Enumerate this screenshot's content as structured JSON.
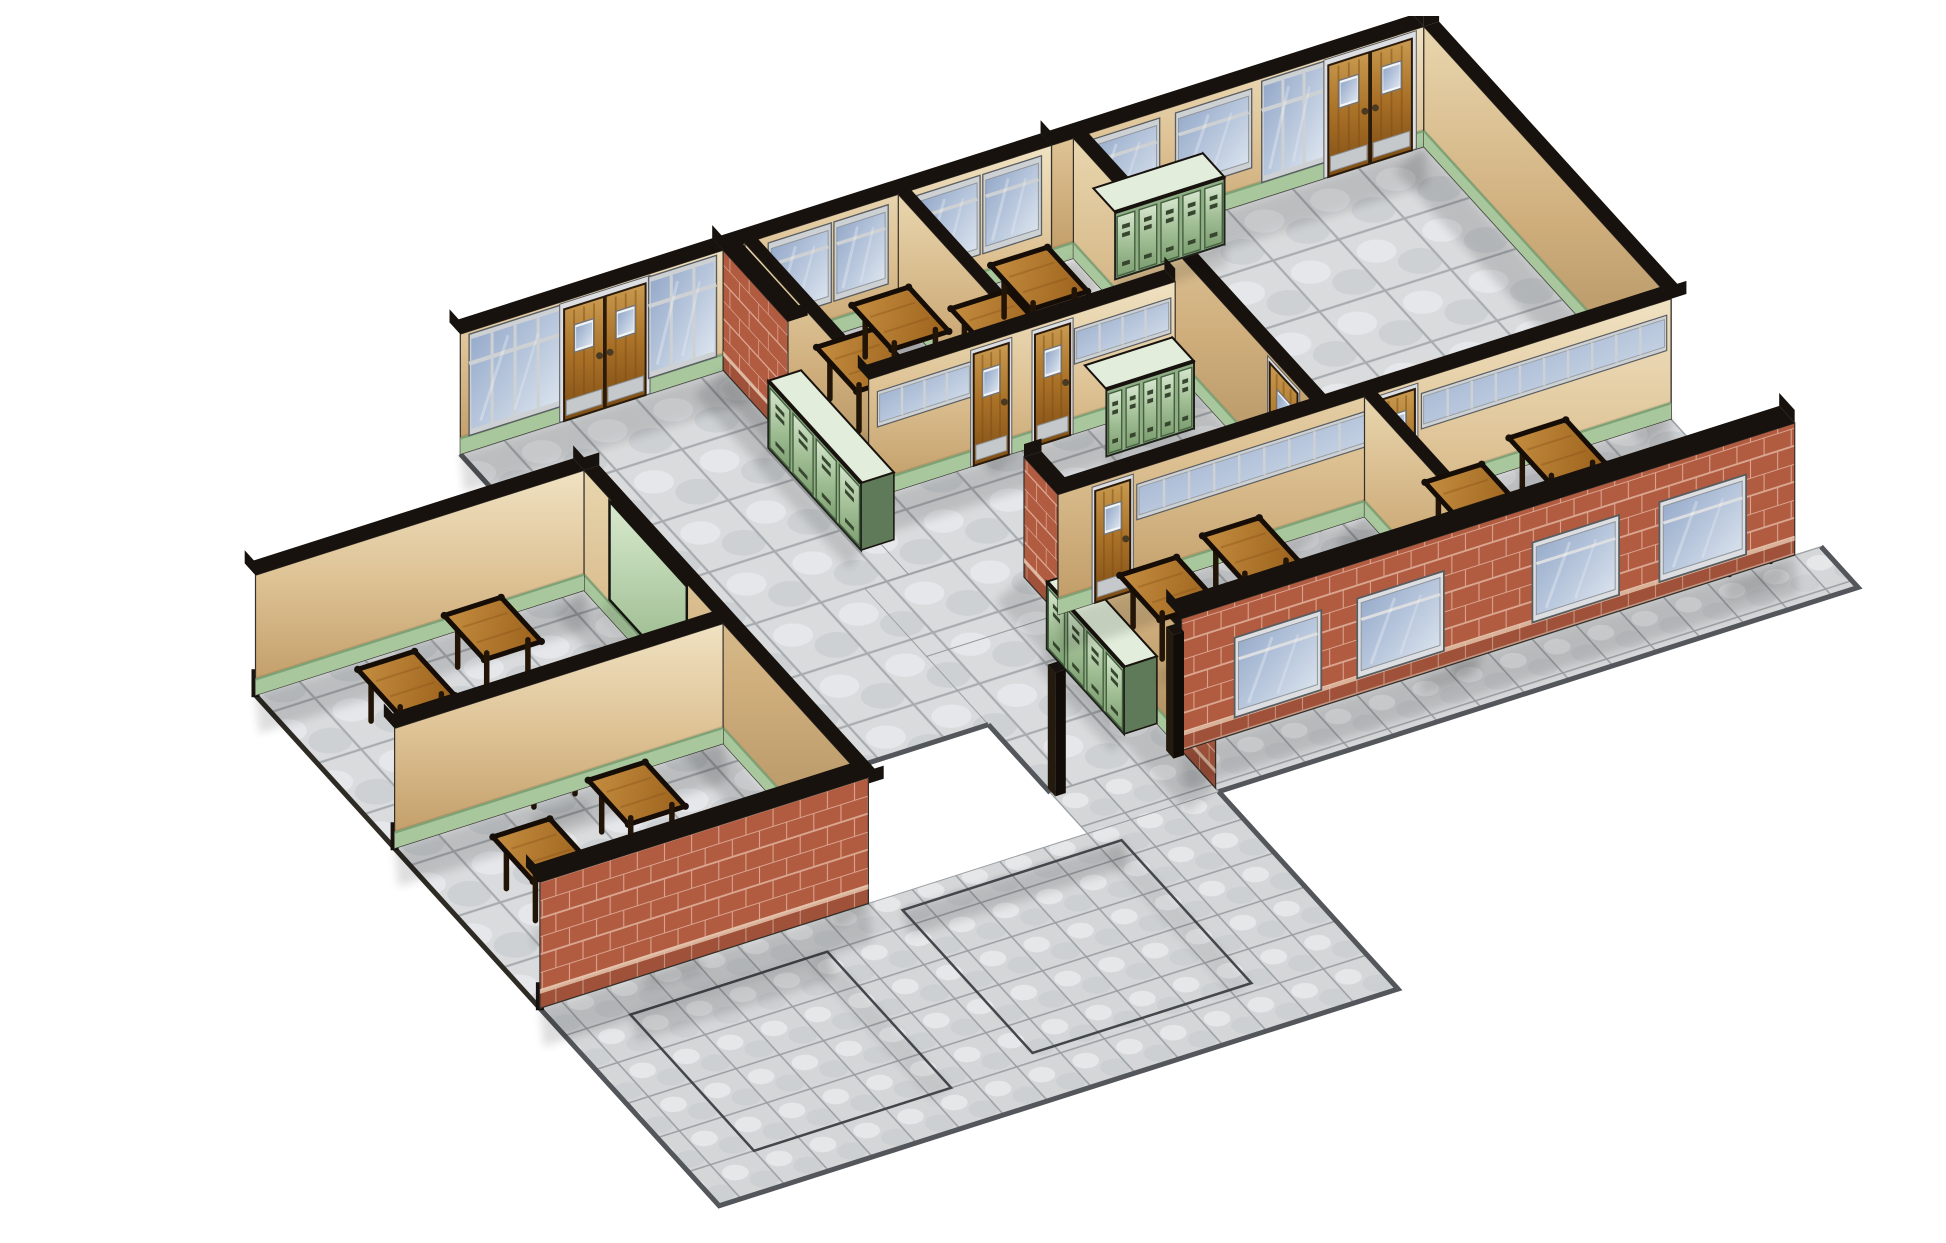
{
  "meta": {
    "description": "Isometric cutaway 3D rendering of a single-storey school wing with classrooms, corridors, locker banks, an entrance hall and an outdoor paved plaza",
    "view": "axonometric cutaway from south-west, roof removed, walls cut with black caps"
  },
  "inventory": {
    "rooms": [
      {
        "name": "entrance-hall",
        "features": [
          "glazed north wall",
          "double wooden doors",
          "green display board"
        ]
      },
      {
        "name": "left-classroom-1",
        "tables": 3
      },
      {
        "name": "left-classroom-2",
        "tables": 4
      },
      {
        "name": "north-classroom-1",
        "tables": 2,
        "windows": 2
      },
      {
        "name": "north-classroom-2",
        "tables": 2,
        "windows": 2
      },
      {
        "name": "northeast-room",
        "tables": 0,
        "locker_doors": 5,
        "features": [
          "windows",
          "glazed end with double doors"
        ]
      },
      {
        "name": "south-classroom-1",
        "tables": 5
      },
      {
        "name": "south-classroom-2",
        "tables": 5
      }
    ],
    "tables_total": 21,
    "locker_banks": [
      {
        "location": "entrance-hall",
        "doors": 4
      },
      {
        "location": "corridor",
        "doors": 5
      },
      {
        "location": "northeast-room",
        "doors": 5
      },
      {
        "location": "south-corridor",
        "doors": 4
      }
    ],
    "doors": {
      "single_wood": 5,
      "double_wood": 2
    },
    "windows": {
      "large": 6,
      "brick_wall": 4,
      "clerestory_bands": 4,
      "glazed_sections": 4
    },
    "plaza": {
      "sunken_pads": 2
    },
    "brick_piers": 3,
    "doorway_posts": 2
  },
  "palette": {
    "wall_face": [
      "#f0e2c2",
      "#ddc193",
      "#bf9a64"
    ],
    "wall_side": [
      "#e9d6ae",
      "#cfae7c",
      "#a8875a"
    ],
    "glass": [
      "#8ea4c6",
      "#b7c6dc",
      "#e3eaf2"
    ],
    "door_wood": [
      "#c99b50",
      "#a86f26",
      "#7d4d15"
    ],
    "table_wood": [
      "#c68f41",
      "#9f651f"
    ],
    "locker_door": [
      "#d7e7cf",
      "#a3c097",
      "#7c9e70"
    ],
    "board_green": [
      "#d8eacd",
      "#8fb283"
    ],
    "wainscot": "#a8c79d",
    "wainscot_dark": "#7da276",
    "frame": "#ced1d4",
    "frame_dark": "#5a5e62",
    "cap": "#17120e",
    "brick": "#b15b41",
    "mortar": "#daa58f",
    "tile": "#d9dbdd",
    "tile_plaza": "#d4d6d8",
    "grout": "#a8acaf",
    "grout_plaza": "#999ea1",
    "tile_light": "#e7e9eb",
    "tile_dark": "#cbcfd2",
    "locker_body": "#8fae85",
    "locker_side": "#5f7a58",
    "locker_top": "#e2eedb",
    "locker_frame": "#45603f",
    "locker_vent": "#37462f",
    "table_leg": "#221507"
  },
  "scene": {
    "proj": {
      "ux": 0.952,
      "uy": -0.304,
      "vx": 0.672,
      "vy": 0.74,
      "s": 46,
      "H": 120,
      "ox": 70,
      "oy": 550
    },
    "objects": [
      {
        "t": "floor",
        "name": "entrance-hall-floor",
        "r": [
          8,
          0,
          6,
          10
        ],
        "p": "i"
      },
      {
        "t": "floor",
        "name": "corridor-east-floor",
        "r": [
          14,
          4,
          8,
          2
        ],
        "p": "i"
      },
      {
        "t": "floor",
        "name": "corridor-mid-floor",
        "r": [
          13,
          6,
          9,
          2
        ],
        "p": "i"
      },
      {
        "t": "floor",
        "name": "corridor-south-floor",
        "r": [
          13,
          8,
          3,
          4
        ],
        "p": "i"
      },
      {
        "t": "floor",
        "name": "north-classroom-1-floor",
        "r": [
          14.5,
          0,
          3.5,
          4
        ],
        "p": "i"
      },
      {
        "t": "floor",
        "name": "north-classroom-2-floor",
        "r": [
          18,
          0,
          3.5,
          4
        ],
        "p": "i"
      },
      {
        "t": "floor",
        "name": "northeast-room-floor",
        "r": [
          22,
          0,
          8,
          8
        ],
        "p": "i"
      },
      {
        "t": "floor",
        "name": "south-classroom-1-floor",
        "r": [
          16,
          8,
          7,
          4
        ],
        "p": "i"
      },
      {
        "t": "floor",
        "name": "south-classroom-2-floor",
        "r": [
          23,
          8,
          7,
          4
        ],
        "p": "i"
      },
      {
        "t": "floor",
        "name": "left-classroom-1-floor",
        "r": [
          0.5,
          4,
          7.5,
          4.5
        ],
        "p": "i"
      },
      {
        "t": "floor",
        "name": "left-classroom-2-floor",
        "r": [
          0.5,
          8.5,
          7.5,
          4.7
        ],
        "p": "i"
      },
      {
        "t": "floor",
        "name": "plaza-paving",
        "r": [
          0.5,
          13.2,
          15.5,
          5.8
        ],
        "p": "p"
      },
      {
        "t": "floor",
        "name": "south-walkway-paving",
        "r": [
          13,
          12,
          17.6,
          1.2
        ],
        "p": "p"
      },
      {
        "t": "inset",
        "name": "plaza-sunken-pad-1",
        "r": [
          2,
          14,
          4.5,
          4
        ]
      },
      {
        "t": "inset",
        "name": "plaza-sunken-pad-2",
        "r": [
          8.5,
          13.6,
          5,
          4.2
        ]
      },
      {
        "t": "trim",
        "name": "floor-edge-hall-west",
        "pts": [
          [
            8,
            0
          ],
          [
            8,
            4
          ]
        ]
      },
      {
        "t": "trim",
        "name": "floor-edge-hall-south",
        "pts": [
          [
            8,
            10
          ],
          [
            13,
            10
          ]
        ]
      },
      {
        "t": "trim",
        "name": "floor-edge-corridor-west",
        "pts": [
          [
            13,
            10
          ],
          [
            13,
            12
          ]
        ]
      },
      {
        "t": "trim",
        "name": "floor-edge-plaza",
        "pts": [
          [
            0.5,
            13.2
          ],
          [
            0.5,
            19
          ],
          [
            16,
            19
          ],
          [
            16,
            13.2
          ]
        ]
      },
      {
        "t": "trim",
        "name": "floor-edge-walkway",
        "pts": [
          [
            16,
            13.2
          ],
          [
            30.6,
            13.2
          ],
          [
            30.6,
            12
          ]
        ]
      },
      {
        "t": "stub",
        "name": "cut-wall-edge-west",
        "x": 0.5,
        "y0": 4,
        "y1": 13.2,
        "mids": [
          8.5
        ]
      },
      {
        "t": "wall",
        "name": "northeast-room-north-wall",
        "k": "ew",
        "c": 0,
        "a0": 21.5,
        "a1": 30,
        "th": 0.35,
        "base": true,
        "items": [
          [
            "win",
            22.3,
            23.9
          ],
          [
            "win",
            24.4,
            26.0
          ],
          [
            "glaz",
            26.3,
            27.75
          ],
          [
            "ddoor",
            27.8,
            29.75
          ]
        ]
      },
      {
        "t": "wall",
        "name": "northeast-room-east-wall",
        "k": "ns",
        "c": 30,
        "a0": 0,
        "a1": 8,
        "th": 0.35,
        "base": true,
        "items": []
      },
      {
        "t": "wall",
        "name": "north-classrooms-window-wall",
        "k": "ew",
        "c": 0,
        "a0": 14,
        "a1": 21.5,
        "th": 0.35,
        "base": true,
        "items": [
          [
            "win",
            15.1,
            16.4
          ],
          [
            "win",
            16.6,
            17.7
          ],
          [
            "win",
            18.5,
            19.8
          ],
          [
            "win",
            20.0,
            21.2
          ]
        ]
      },
      {
        "t": "wall",
        "name": "entrance-glazed-wall",
        "k": "ew",
        "c": 0,
        "a0": 8,
        "a1": 14,
        "th": 0.35,
        "base": true,
        "items": [
          [
            "glaz",
            8.2,
            10.3
          ],
          [
            "ddoor",
            10.35,
            12.25
          ],
          [
            "glaz",
            12.3,
            13.85
          ]
        ]
      },
      {
        "t": "wall",
        "name": "hall-east-wall",
        "k": "ns",
        "c": 14.5,
        "a0": 0,
        "a1": 4,
        "th": 0.3,
        "base": true,
        "items": []
      },
      {
        "t": "wall",
        "name": "brick-pier-hall",
        "k": "ns",
        "c": 14,
        "a0": 0,
        "a1": 2.1,
        "th": 0.45,
        "face": "brick",
        "items": []
      },
      {
        "t": "wall",
        "name": "north-classroom-divider",
        "k": "ns",
        "c": 18,
        "a0": 0,
        "a1": 4,
        "th": 0.3,
        "base": true,
        "items": []
      },
      {
        "t": "wall",
        "name": "northeast-room-west-wall",
        "k": "ns",
        "c": 22,
        "a0": 0,
        "a1": 8,
        "th": 0.35,
        "base": true,
        "items": [
          [
            "door",
            6.35,
            7.25
          ]
        ]
      },
      {
        "t": "lockers",
        "name": "locker-bank-northeast-room",
        "dir": "s",
        "x0": 22.4,
        "x1": 24.9,
        "y0": 0.08,
        "y1": 0.78,
        "n": 5
      },
      {
        "t": "table",
        "name": "table",
        "x": 15.9,
        "y": 1.9
      },
      {
        "t": "table",
        "name": "table",
        "x": 17.2,
        "y": 1.2
      },
      {
        "t": "table",
        "name": "table",
        "x": 18.9,
        "y": 2.0
      },
      {
        "t": "table",
        "name": "table",
        "x": 20.3,
        "y": 1.3
      },
      {
        "t": "wall",
        "name": "corridor-north-wall",
        "k": "ew",
        "c": 4,
        "a0": 14.5,
        "a1": 21.5,
        "th": 0.35,
        "base": true,
        "items": [
          [
            "cwin",
            14.75,
            16.8
          ],
          [
            "door",
            16.9,
            17.7
          ],
          [
            "door",
            18.3,
            19.1
          ],
          [
            "cwin",
            19.25,
            21.35
          ]
        ]
      },
      {
        "t": "lockers",
        "name": "locker-bank-hall",
        "dir": "w",
        "x0": 13.55,
        "x1": 14.3,
        "y0": 2.1,
        "y1": 5.1,
        "n": 4
      },
      {
        "t": "lockers",
        "name": "locker-bank-corridor",
        "dir": "s",
        "x0": 19.4,
        "x1": 21.4,
        "y0": 4.05,
        "y1": 4.75,
        "n": 5
      },
      {
        "t": "wall",
        "name": "hall-west-wall",
        "k": "ns",
        "c": 8,
        "a0": 4,
        "a1": 13.2,
        "th": 0.35,
        "base": true,
        "items": []
      },
      {
        "t": "board",
        "name": "display-board",
        "x": 8.3,
        "y0": 4.4,
        "y1": 6.9
      },
      {
        "t": "wall",
        "name": "left-classroom-1-north-wall",
        "k": "ew",
        "c": 4,
        "a0": 0.5,
        "a1": 8,
        "th": 0.35,
        "base": true,
        "items": []
      },
      {
        "t": "table",
        "name": "table",
        "x": 2.6,
        "y": 5.9
      },
      {
        "t": "table",
        "name": "table",
        "x": 5.0,
        "y": 5.3
      },
      {
        "t": "table",
        "name": "table",
        "x": 4.1,
        "y": 8.1
      },
      {
        "t": "wall",
        "name": "left-classroom-divider",
        "k": "ew",
        "c": 8.5,
        "a0": 0.5,
        "a1": 8,
        "th": 0.35,
        "base": true,
        "items": []
      },
      {
        "t": "table",
        "name": "table",
        "x": 2.3,
        "y": 10.7
      },
      {
        "t": "table",
        "name": "table",
        "x": 4.9,
        "y": 10.1
      },
      {
        "t": "table",
        "name": "table",
        "x": 3.6,
        "y": 12.5
      },
      {
        "t": "table",
        "name": "table",
        "x": 6.3,
        "y": 11.8
      },
      {
        "t": "wall",
        "name": "left-block-brick-wall",
        "k": "ew",
        "c": 13.2,
        "a0": 0.5,
        "a1": 8,
        "th": 0.45,
        "face": "brick",
        "h": 1.05,
        "items": []
      },
      {
        "t": "wall",
        "name": "brick-pier-mid",
        "k": "ns",
        "c": 16,
        "a0": 6.9,
        "a1": 8,
        "th": 0.4,
        "face": "brick",
        "items": []
      },
      {
        "t": "wall",
        "name": "south-corridor-east-wall",
        "k": "ns",
        "c": 16,
        "a0": 8,
        "a1": 12,
        "th": 0.3,
        "base": true,
        "items": []
      },
      {
        "t": "lockers",
        "name": "locker-bank-south-corridor",
        "dir": "w",
        "x0": 15.25,
        "x1": 16,
        "y0": 8.7,
        "y1": 11.2,
        "n": 4
      },
      {
        "t": "wall",
        "name": "brick-pier-walkway",
        "k": "ns",
        "c": 16,
        "a0": 12,
        "a1": 13.1,
        "th": 0.45,
        "face": "brick",
        "items": []
      },
      {
        "t": "wall",
        "name": "south-classrooms-north-wall",
        "k": "ew",
        "c": 8,
        "a0": 16,
        "a1": 30,
        "th": 0.35,
        "base": true,
        "items": [
          [
            "door",
            16.85,
            17.65
          ],
          [
            "cwin",
            17.85,
            23.0
          ],
          [
            "door",
            23.35,
            24.15
          ],
          [
            "cwin",
            24.35,
            29.85
          ]
        ]
      },
      {
        "t": "wall",
        "name": "south-classroom-divider",
        "k": "ns",
        "c": 23,
        "a0": 8,
        "a1": 12,
        "th": 0.3,
        "base": true,
        "items": []
      },
      {
        "t": "table",
        "name": "table",
        "x": 17.6,
        "y": 9.3
      },
      {
        "t": "table",
        "name": "table",
        "x": 19.7,
        "y": 9.0
      },
      {
        "t": "table",
        "name": "table",
        "x": 18.5,
        "y": 10.8
      },
      {
        "t": "table",
        "name": "table",
        "x": 20.8,
        "y": 10.4
      },
      {
        "t": "table",
        "name": "table",
        "x": 22.1,
        "y": 11.4
      },
      {
        "t": "table",
        "name": "table",
        "x": 24.5,
        "y": 9.4
      },
      {
        "t": "table",
        "name": "table",
        "x": 26.7,
        "y": 9.0
      },
      {
        "t": "table",
        "name": "table",
        "x": 25.4,
        "y": 10.9
      },
      {
        "t": "table",
        "name": "table",
        "x": 27.7,
        "y": 10.5
      },
      {
        "t": "table",
        "name": "table",
        "x": 29.0,
        "y": 11.5
      },
      {
        "t": "wall",
        "name": "southeast-brick-wall",
        "k": "ew",
        "c": 12,
        "a0": 16,
        "a1": 30,
        "th": 0.5,
        "face": "brick",
        "h": 1.1,
        "items": [
          [
            "bwin",
            17.3,
            19.1
          ],
          [
            "bwin",
            20.1,
            21.9
          ],
          [
            "bwin",
            24.1,
            25.9
          ],
          [
            "bwin",
            27.0,
            28.8
          ]
        ]
      },
      {
        "t": "post",
        "name": "doorway-post",
        "x": 13.15,
        "y": 12
      },
      {
        "t": "post",
        "name": "doorway-post",
        "x": 15.85,
        "y": 12
      }
    ]
  }
}
